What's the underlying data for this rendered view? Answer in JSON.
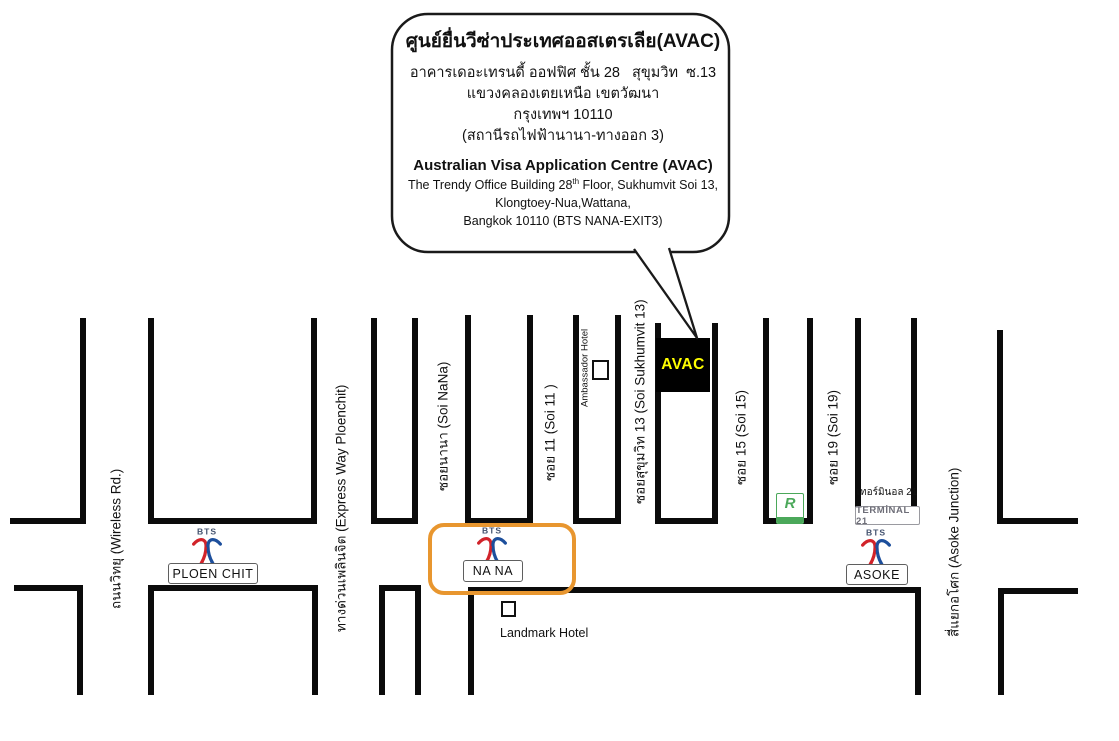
{
  "callout": {
    "thai_title": "ศูนย์ยื่นวีซ่าประเทศออสเตรเลีย(AVAC)",
    "thai_lines": [
      "อาคารเดอะเทรนดี้ ออฟฟิศ ชั้น 28   สุขุมวิท  ซ.13",
      "แขวงคลองเตยเหนือ เขตวัฒนา",
      "กรุงเทพฯ 10110",
      "(สถานีรถไฟฟ้านานา-ทางออก 3)"
    ],
    "en_title": "Australian Visa Application Centre (AVAC)",
    "en_line1_pre": "The Trendy Office Building 28",
    "en_line1_sup": "th",
    "en_line1_post": " Floor, Sukhumvit Soi 13,",
    "en_line2": "Klongtoey-Nua,Wattana,",
    "en_line3": "Bangkok 10110 (BTS NANA-EXIT3)"
  },
  "map": {
    "streets": [
      {
        "id": "wireless-road",
        "label": "ถนนวิทยุ (Wireless Rd.)"
      },
      {
        "id": "expressway-ploenchit",
        "label": "ทางด่วนเพลินจิต (Express Way Ploenchit)"
      },
      {
        "id": "soi-nana",
        "label": "ซอยนานา (Soi NaNa)"
      },
      {
        "id": "soi-11",
        "label": "ซอย 11 (Soi 11 )"
      },
      {
        "id": "soi-sukhumvit-13",
        "label": "ซอยสุขุมวิท 13 (Soi Sukhumvit 13)"
      },
      {
        "id": "soi-15",
        "label": "ซอย 15 (Soi 15)"
      },
      {
        "id": "soi-19",
        "label": "ซอย 19 (Soi 19)"
      },
      {
        "id": "asoke-junction",
        "label": "สี่แยกอโศก (Asoke Junction)"
      }
    ],
    "stations": [
      {
        "name": "PLOEN CHIT"
      },
      {
        "name": "NA NA"
      },
      {
        "name": "ASOKE"
      }
    ],
    "bts_logo_text": "BTS",
    "pois": {
      "avac": "AVAC",
      "ambassador_hotel": "Ambassador Hotel",
      "landmark_hotel": "Landmark Hotel",
      "terminal21_thai": "เทอร์มินอล 21",
      "terminal21_logo": "TERMİNAL 21",
      "robinson_initial": "R"
    },
    "colors": {
      "road": "#0b0b0b",
      "avac_bg": "#000000",
      "avac_text": "#FFFF00",
      "nana_highlight": "#E8962F",
      "bts_red": "#D1232A",
      "bts_blue": "#1D4F9C",
      "robinson_green": "#4BA85A",
      "terminal21_gray": "#6E6E78"
    }
  }
}
